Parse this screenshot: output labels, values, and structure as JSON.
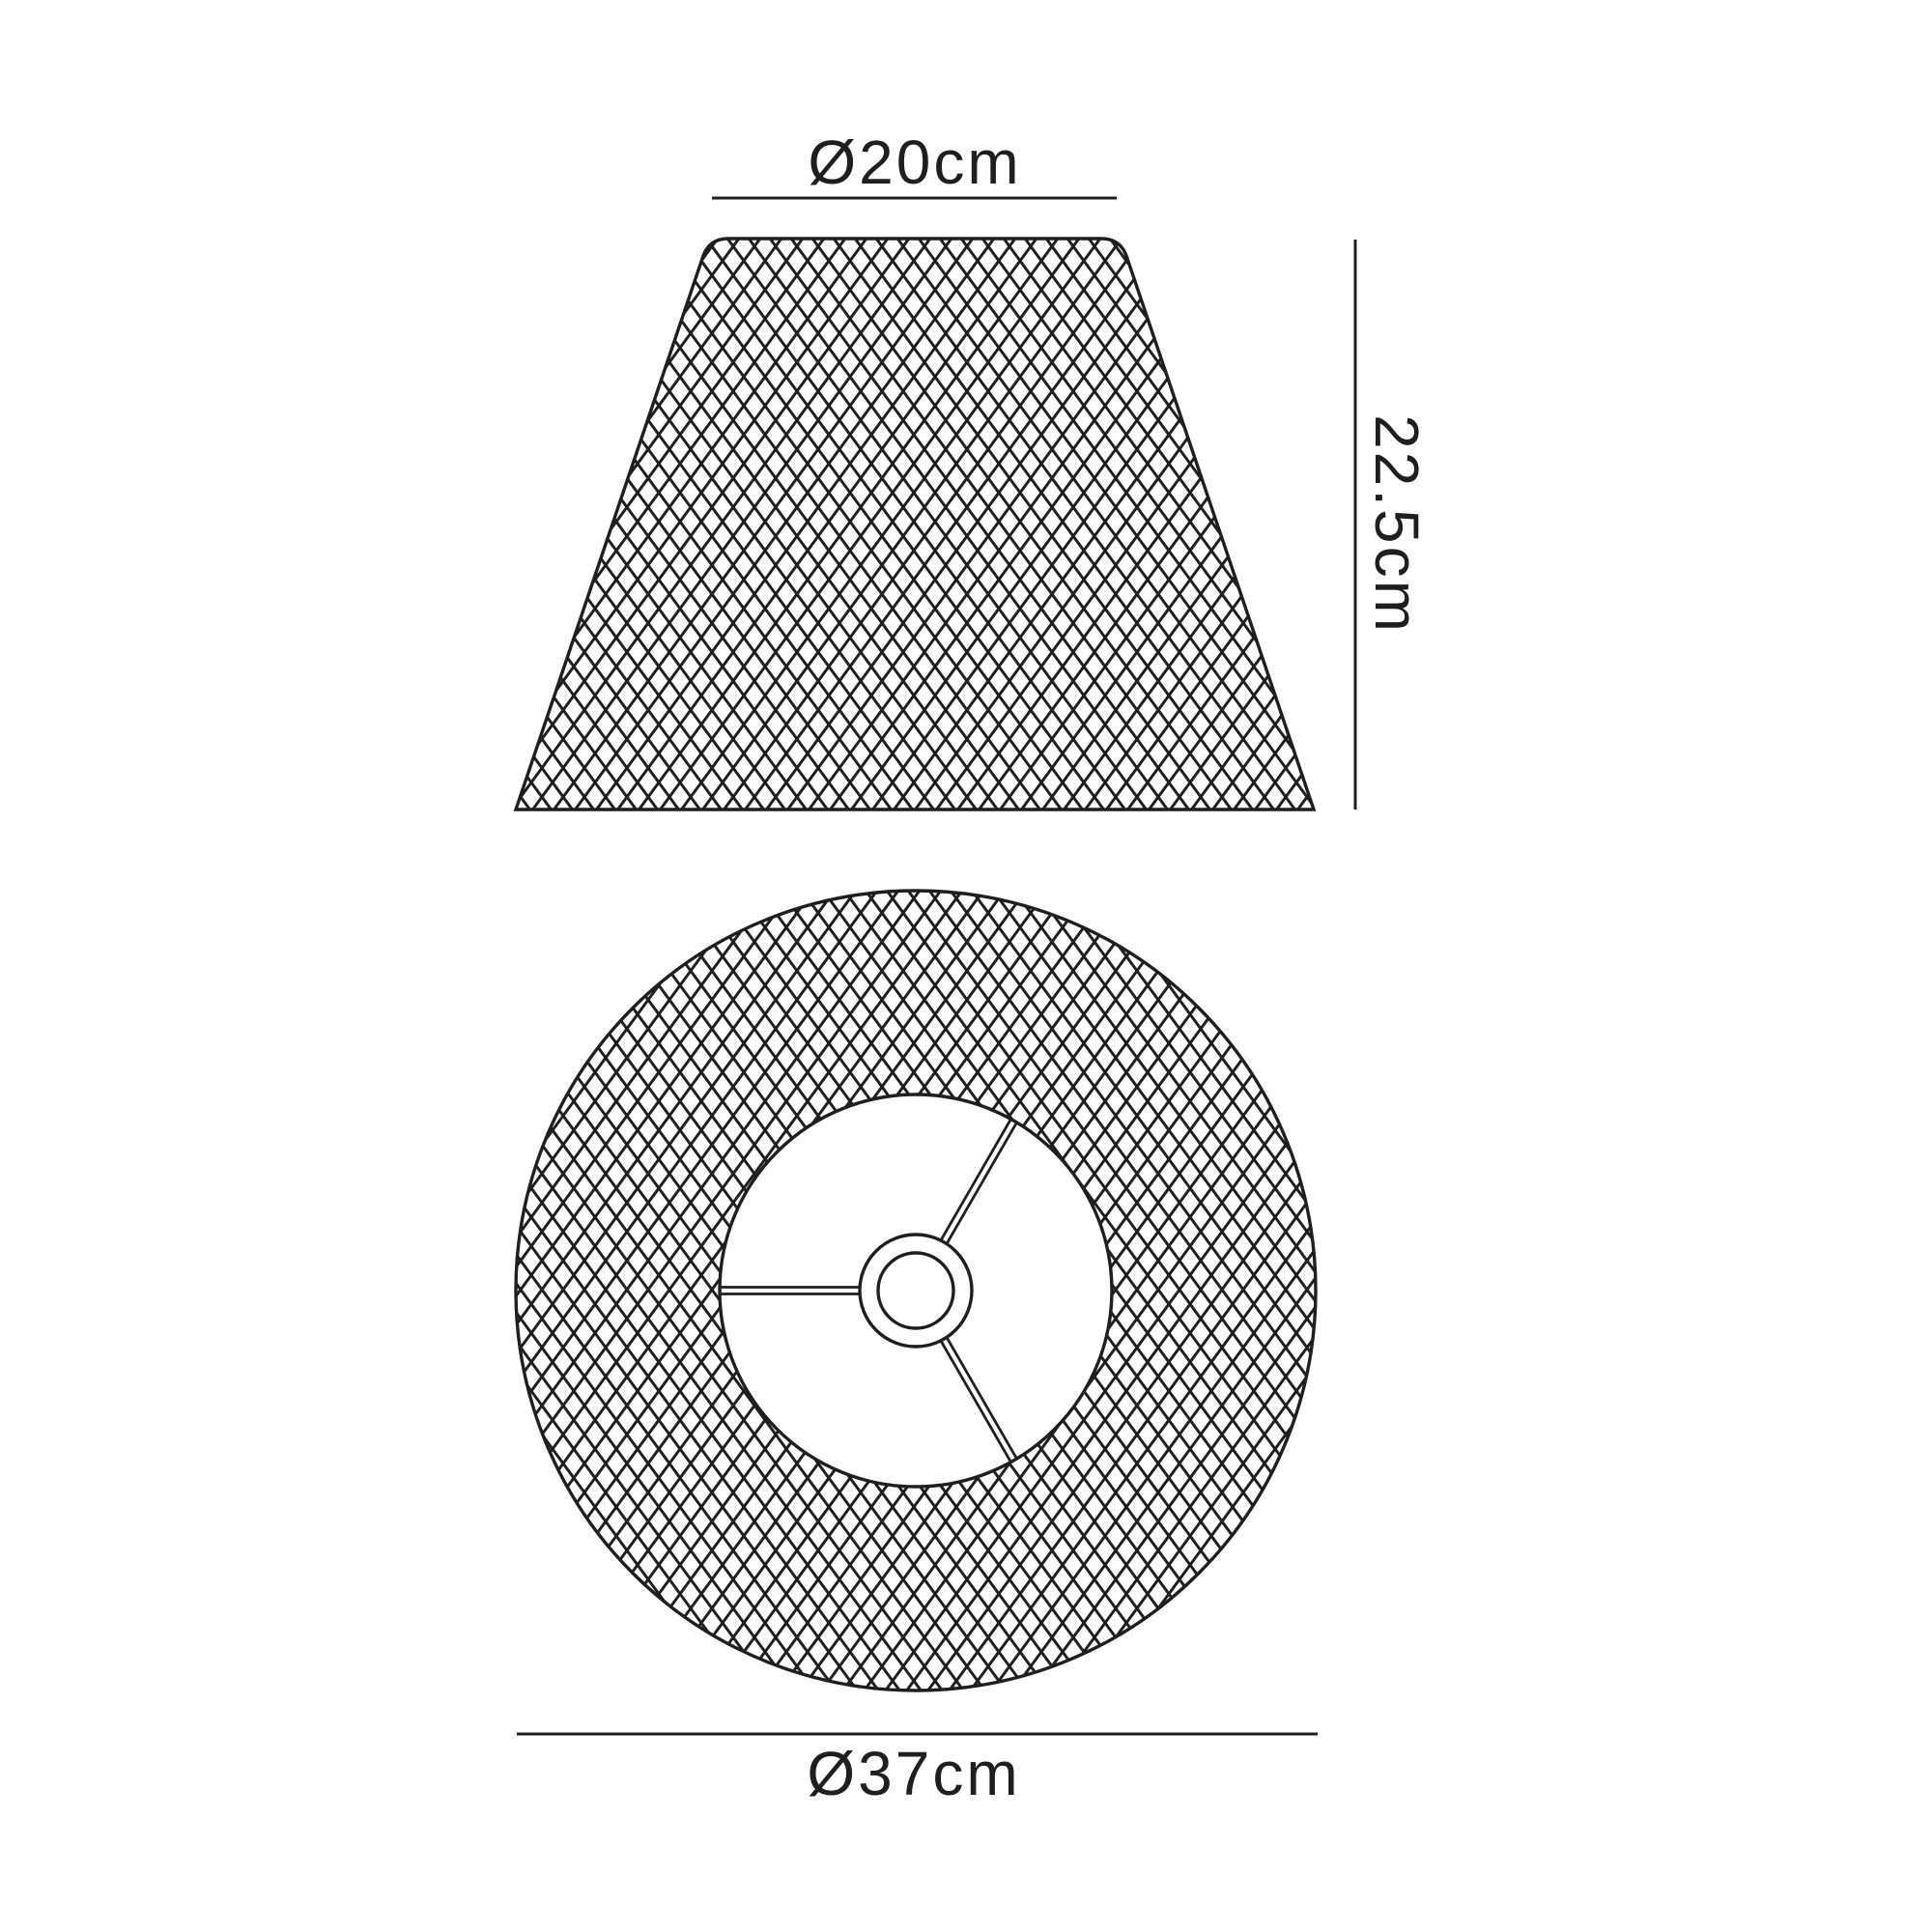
{
  "diagram": {
    "colors": {
      "line": "#1f1f1f",
      "background": "#ffffff"
    },
    "side_view": {
      "top_diameter_label": "Ø20cm",
      "height_label": "22.5cm"
    },
    "top_view": {
      "diameter_label": "Ø37cm"
    }
  }
}
